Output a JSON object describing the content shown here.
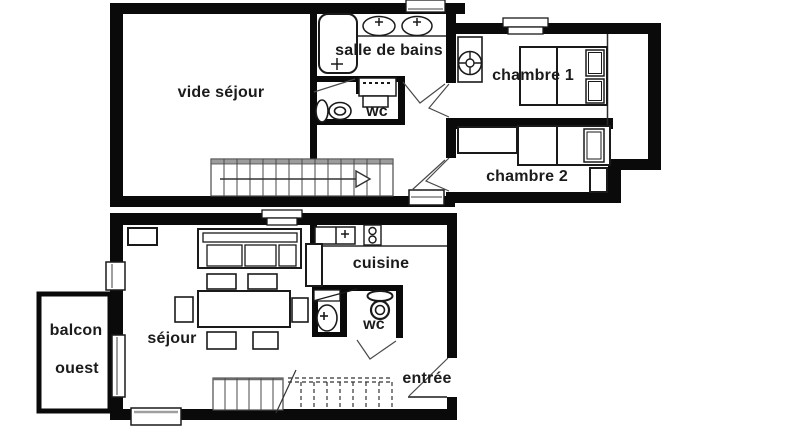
{
  "title": "Plan d'appartement duplex",
  "colors": {
    "wall": "#0a0a0a",
    "line": "#1a1a1a",
    "stair_gray": "#9c9c9c",
    "window_gray": "#9f9f9f",
    "text": "#1b1b1b",
    "background": "#ffffff"
  },
  "upper_floor": {
    "name": "étage",
    "rooms": {
      "vide_sejour": "vide séjour",
      "salle_de_bains": "salle de bains",
      "wc": "wc",
      "chambre1": "chambre 1",
      "chambre2": "chambre 2"
    }
  },
  "lower_floor": {
    "name": "rez",
    "rooms": {
      "balcon_line1": "balcon",
      "balcon_line2": "ouest",
      "sejour": "séjour",
      "cuisine": "cuisine",
      "wc": "wc",
      "entree": "entrée"
    }
  }
}
